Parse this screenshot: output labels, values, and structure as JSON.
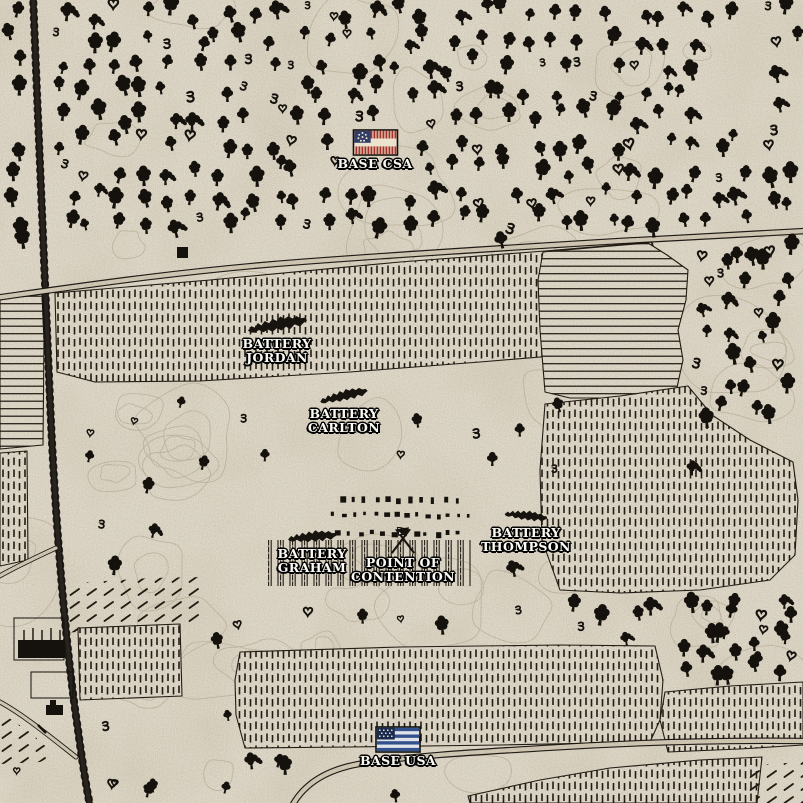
{
  "colors": {
    "paper": "#e8e1d0",
    "ink": "#17130e",
    "contour": "#c7bca5",
    "field_ink": "#241e15",
    "road_fill": "#dbd2bd",
    "stain": "#b9a888",
    "label_text": "#fbfaf4",
    "label_outline": "#000000",
    "csa_flag": {
      "canton": "#323e68",
      "stripe_hatch": "#a23128",
      "stripe_light": "#ece3cf",
      "stars": "#f0ead9"
    },
    "usa_flag": {
      "canton": "#1c2a4c",
      "stripe_dark": "#31508c",
      "stripe_light": "#dfe3e9",
      "stars": "#e8ecf2"
    }
  },
  "markers": {
    "base_csa": {
      "label": "BASE CSA",
      "icon": "csa-flag"
    },
    "battery_jordan": {
      "line1": "BATTERY",
      "line2": "JORDAN",
      "icon": "battery"
    },
    "battery_carlton": {
      "line1": "BATTERY",
      "line2": "CARLTON",
      "icon": "battery"
    },
    "battery_graham": {
      "line1": "BATTERY",
      "line2": "GRAHAM",
      "icon": "battery"
    },
    "battery_thompson": {
      "line1": "BATTERY",
      "line2": "THOMPSON",
      "icon": "battery"
    },
    "point_of_contention": {
      "line1": "POINT OF",
      "line2": "CONTENTION",
      "icon": "crossed-flags"
    },
    "base_usa": {
      "label": "BASE USA",
      "icon": "usa-flag"
    }
  }
}
